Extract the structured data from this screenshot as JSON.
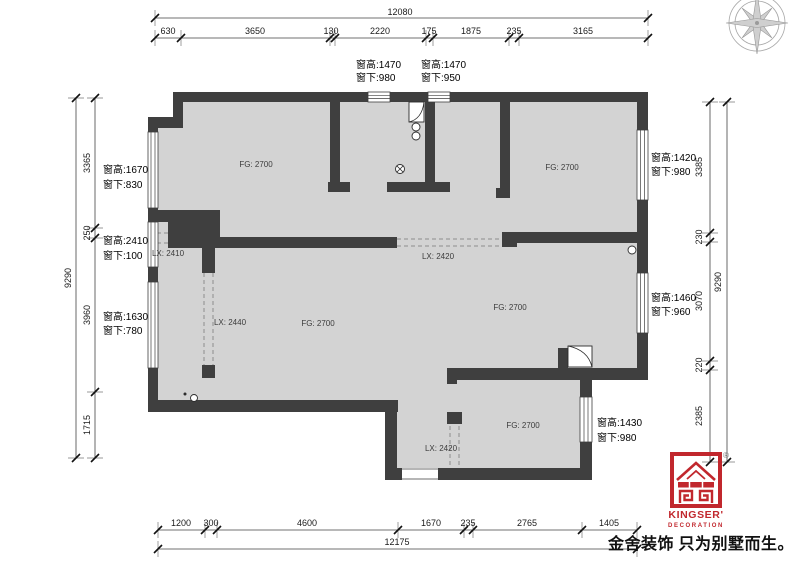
{
  "title": "residential floor plan",
  "colors": {
    "wall": "#3f3f3f",
    "floor": "#d3d3d3",
    "logo_red": "#c1272d"
  },
  "dims": {
    "top": {
      "total": "12080",
      "segments": [
        "630",
        "3650",
        "130",
        "2220",
        "175",
        "1875",
        "235",
        "3165"
      ]
    },
    "bottom": {
      "total": "12175",
      "segments": [
        "1200",
        "300",
        "4600",
        "1670",
        "235",
        "2765",
        "1405"
      ]
    },
    "left": {
      "total": "9290",
      "segments": [
        "3365",
        "250",
        "3960",
        "1715"
      ]
    },
    "right": {
      "total": "9290",
      "segments": [
        "3385",
        "230",
        "3070",
        "220",
        "2385"
      ]
    }
  },
  "windows": {
    "top1": {
      "l1": "窗高:1470",
      "l2": "窗下:980"
    },
    "top2": {
      "l1": "窗高:1470",
      "l2": "窗下:950"
    },
    "left1": {
      "l1": "窗高:1670",
      "l2": "窗下:830"
    },
    "left2": {
      "l1": "窗高:2410",
      "l2": "窗下:100"
    },
    "left3": {
      "l1": "窗高:1630",
      "l2": "窗下:780"
    },
    "right1": {
      "l1": "窗高:1420",
      "l2": "窗下:980"
    },
    "right2": {
      "l1": "窗高:1460",
      "l2": "窗下:960"
    },
    "right3": {
      "l1": "窗高:1430",
      "l2": "窗下:980"
    }
  },
  "rooms": {
    "fg2700": "FG: 2700",
    "lx2410": "LX: 2410",
    "lx2420": "LX: 2420",
    "lx2440": "LX: 2440"
  },
  "logo": {
    "brand": "KINGSER'",
    "sub": "DECORATION",
    "registered": "®",
    "slogan": "金舍装饰 只为别墅而生。"
  }
}
